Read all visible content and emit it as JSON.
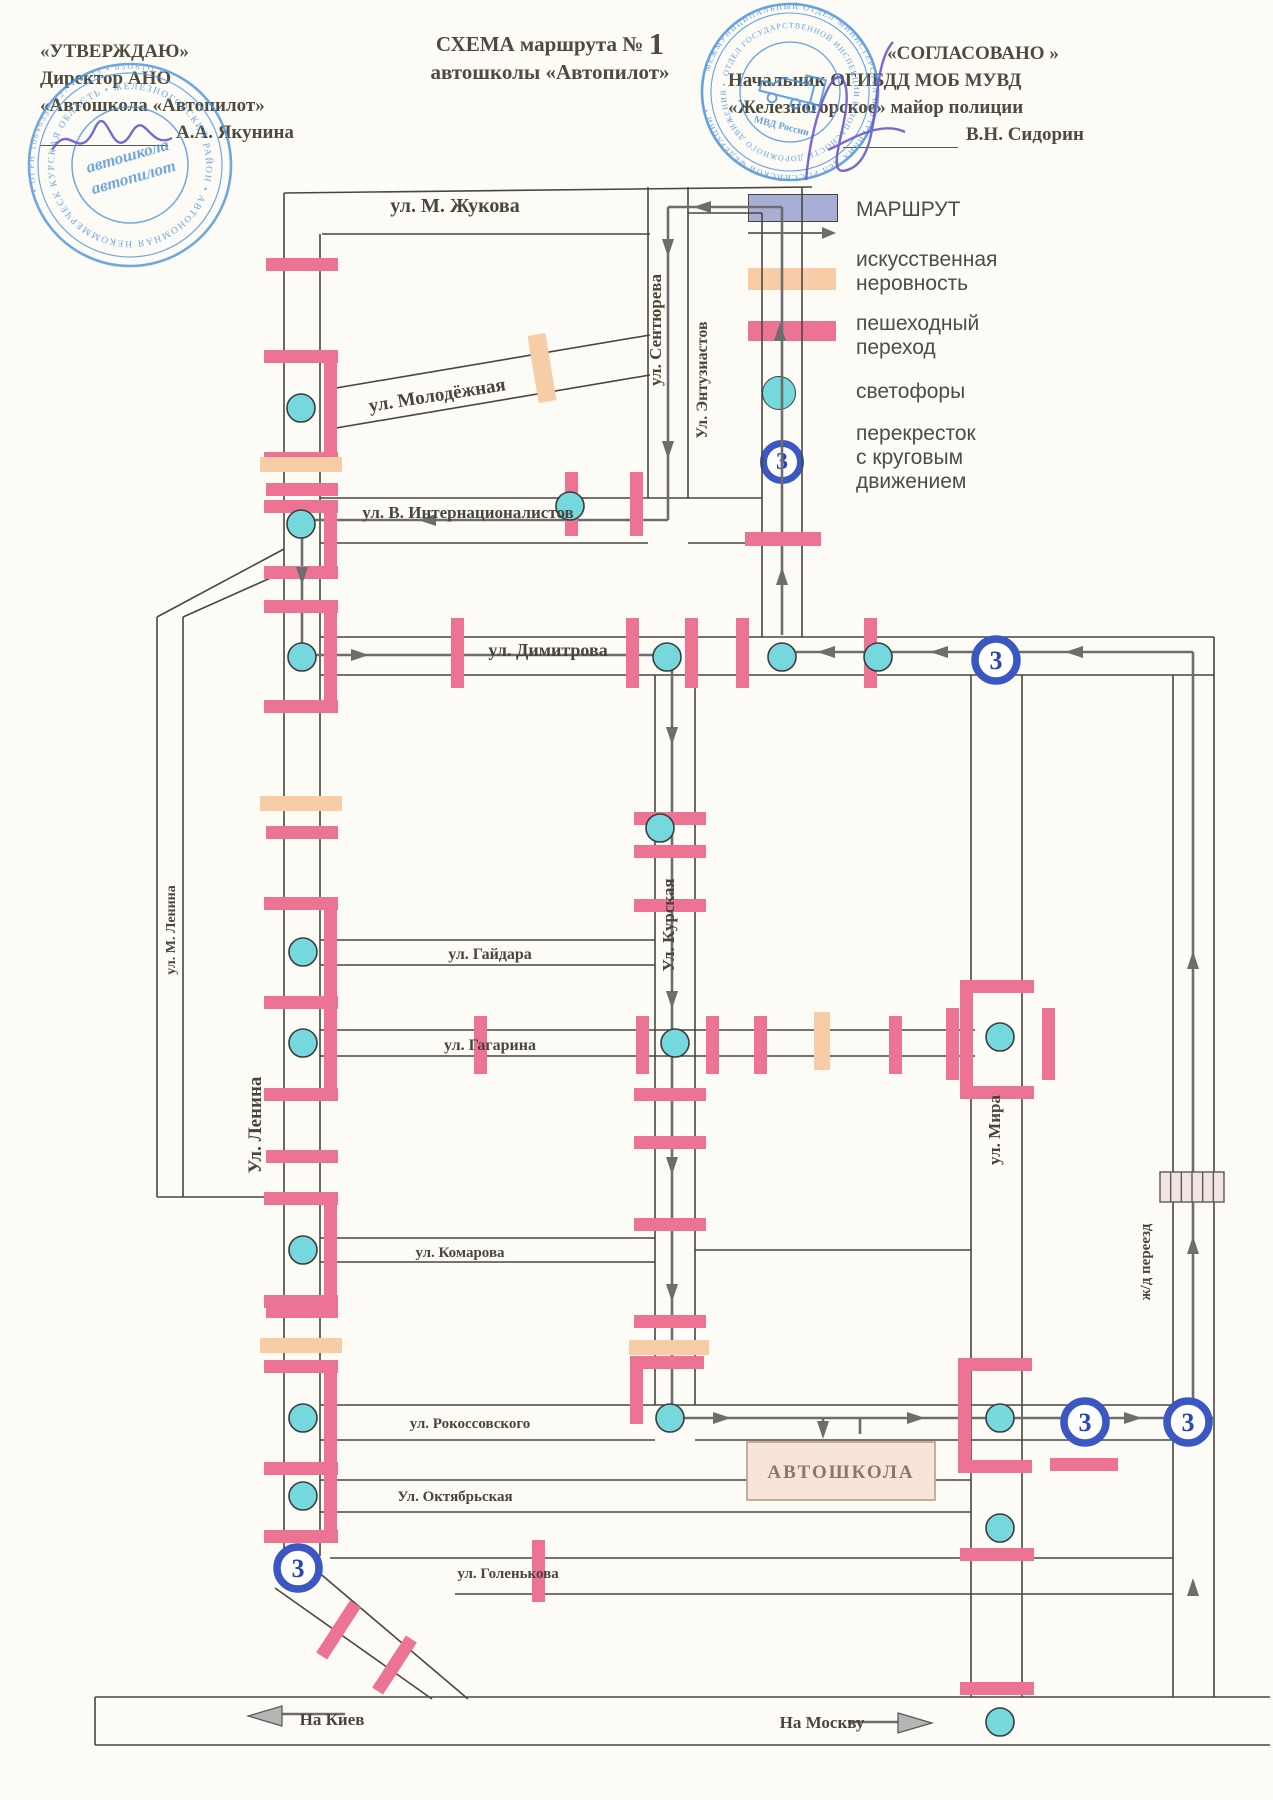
{
  "header": {
    "approve": {
      "line1": "«УТВЕРЖДАЮ»",
      "line2": "Директор АНО",
      "line3": "«Автошкола «Автопилот»",
      "name": "А.А. Якунина"
    },
    "title": {
      "prefix": "СХЕМА маршрута №",
      "number": "1",
      "line2": "автошколы «Автопилот»"
    },
    "agree": {
      "line1": "«СОГЛАСОВАНО »",
      "line2": "Начальник ОГИБДД МОБ МУВД",
      "line3": "«Железногорское» майор полиции",
      "name": "В.Н. Сидорин"
    }
  },
  "stamps": {
    "left": {
      "ring_text": "КУРСКАЯ ОБЛАСТЬ • ЖЕЛЕЗНОГОРСКИЙ РАЙОН • АВТОНОМНАЯ НЕКОММЕРЧЕСКАЯ ОРГАНИЗАЦИЯ •",
      "outer_text": "• ОГРН 106463301127 • 4633 • б5О81О •",
      "center1": "автошкола",
      "center2": "автопилот"
    },
    "right": {
      "ring_text": "ОТДЕЛ ГОСУДАРСТВЕННОЙ ИНСПЕКЦИИ БЕЗОПАСНОСТИ ДОРОЖНОГО ДВИЖЕНИЯ •",
      "outer_text": "МЕЖМУНИЦИПАЛЬНЫЙ ОТДЕЛ МИНИСТЕРСТВА ВНУТРЕННИХ ДЕЛ РОССИЙСКОЙ ФЕДЕРАЦИИ •",
      "bottom": "МВД России"
    }
  },
  "legend": {
    "route_label": "МАРШРУТ",
    "bump_label1": "искусственная",
    "bump_label2": "неровность",
    "cross_label1": "пешеходный",
    "cross_label2": "переход",
    "light_label": "светофоры",
    "round_label1": "перекресток",
    "round_label2": "с круговым",
    "round_label3": "движением"
  },
  "colors": {
    "road": "#474640",
    "route": "#6d6d6d",
    "pink": "#ec7492",
    "peach": "#f6cda6",
    "light": "#74d8dd",
    "ring": "#3a57c2",
    "number": "#2a47b2",
    "text": "#49453a",
    "lavender": "#a9aed6",
    "stamp": "#4e93d9",
    "signature": "#6a5ac8",
    "school_bg": "#f8e4d9",
    "school_border": "#bda globa"
  },
  "map": {
    "roundabout_label": "3",
    "school_label": "АВТОШКОЛА",
    "street_labels": [
      {
        "t": "ул. М. Жукова",
        "x": 455,
        "y": 212,
        "r": 0,
        "s": 20
      },
      {
        "t": "ул. Молодёжная",
        "x": 438,
        "y": 401,
        "r": -9,
        "s": 19
      },
      {
        "t": "ул. Сентюрева",
        "x": 661,
        "y": 330,
        "r": -90,
        "s": 17
      },
      {
        "t": "Ул. Энтузиастов",
        "x": 707,
        "y": 380,
        "r": -90,
        "s": 16
      },
      {
        "t": "ул. В. Интернационалистов",
        "x": 468,
        "y": 518,
        "r": 0,
        "s": 17
      },
      {
        "t": "ул. Димитрова",
        "x": 548,
        "y": 656,
        "r": 0,
        "s": 18
      },
      {
        "t": "ул. М. Ленина",
        "x": 175,
        "y": 930,
        "r": -90,
        "s": 14
      },
      {
        "t": "Ул. Ленина",
        "x": 261,
        "y": 1125,
        "r": -90,
        "s": 19
      },
      {
        "t": "ул. Гайдара",
        "x": 490,
        "y": 959,
        "r": 0,
        "s": 16
      },
      {
        "t": "Ул. Курская",
        "x": 674,
        "y": 925,
        "r": -90,
        "s": 17
      },
      {
        "t": "ул. Гагарина",
        "x": 490,
        "y": 1050,
        "r": 0,
        "s": 16
      },
      {
        "t": "ул. Мира",
        "x": 1000,
        "y": 1130,
        "r": -90,
        "s": 17
      },
      {
        "t": "ул. Комарова",
        "x": 460,
        "y": 1257,
        "r": 0,
        "s": 15
      },
      {
        "t": "ул. Рокоссовского",
        "x": 470,
        "y": 1428,
        "r": 0,
        "s": 15
      },
      {
        "t": "Ул. Октябрьская",
        "x": 455,
        "y": 1501,
        "r": 0,
        "s": 15
      },
      {
        "t": "ул. Голенькова",
        "x": 508,
        "y": 1578,
        "r": 0,
        "s": 15
      },
      {
        "t": "ж/д переезд",
        "x": 1150,
        "y": 1262,
        "r": -90,
        "s": 15
      },
      {
        "t": "На Киев",
        "x": 332,
        "y": 1725,
        "r": 0,
        "s": 17
      },
      {
        "t": "На Москву",
        "x": 822,
        "y": 1728,
        "r": 0,
        "s": 17
      }
    ],
    "road_lines": [
      [
        284,
        193,
        812,
        187
      ],
      [
        322,
        234,
        650,
        234
      ],
      [
        688,
        213,
        762,
        213
      ],
      [
        284,
        193,
        284,
        1552
      ],
      [
        320,
        234,
        320,
        1556
      ],
      [
        648,
        187,
        648,
        498
      ],
      [
        688,
        187,
        688,
        498
      ],
      [
        762,
        213,
        762,
        637
      ],
      [
        802,
        187,
        802,
        637
      ],
      [
        330,
        389,
        650,
        335
      ],
      [
        330,
        429,
        650,
        375
      ],
      [
        320,
        498,
        762,
        498
      ],
      [
        320,
        543,
        648,
        543
      ],
      [
        688,
        543,
        762,
        543
      ],
      [
        320,
        637,
        1214,
        637
      ],
      [
        320,
        675,
        1214,
        675
      ],
      [
        157,
        617,
        157,
        1197
      ],
      [
        183,
        617,
        183,
        1197
      ],
      [
        157,
        617,
        284,
        549
      ],
      [
        183,
        617,
        284,
        572
      ],
      [
        157,
        1197,
        283,
        1197
      ],
      [
        320,
        940,
        655,
        940
      ],
      [
        320,
        965,
        655,
        965
      ],
      [
        655,
        675,
        655,
        1405
      ],
      [
        695,
        675,
        695,
        1405
      ],
      [
        320,
        1030,
        975,
        1030
      ],
      [
        320,
        1056,
        975,
        1056
      ],
      [
        971,
        675,
        971,
        1697
      ],
      [
        1022,
        675,
        1022,
        1697
      ],
      [
        320,
        1238,
        655,
        1238
      ],
      [
        320,
        1262,
        655,
        1262
      ],
      [
        695,
        1250,
        971,
        1250
      ],
      [
        320,
        1405,
        1173,
        1405
      ],
      [
        320,
        1440,
        655,
        1440
      ],
      [
        695,
        1440,
        1173,
        1440
      ],
      [
        320,
        1480,
        971,
        1480
      ],
      [
        320,
        1512,
        971,
        1512
      ],
      [
        330,
        1558,
        1173,
        1558
      ],
      [
        455,
        1594,
        1173,
        1594
      ],
      [
        95,
        1697,
        1270,
        1697
      ],
      [
        95,
        1745,
        1270,
        1745
      ],
      [
        95,
        1697,
        95,
        1745
      ],
      [
        275,
        1588,
        432,
        1699
      ],
      [
        310,
        1565,
        468,
        1699
      ],
      [
        1173,
        675,
        1173,
        1697
      ],
      [
        1214,
        637,
        1214,
        1697
      ]
    ],
    "route_lines": [
      [
        782,
        635,
        782,
        207
      ],
      [
        782,
        207,
        668,
        207
      ],
      [
        668,
        207,
        668,
        520
      ],
      [
        668,
        520,
        302,
        520
      ],
      [
        302,
        520,
        302,
        652
      ],
      [
        302,
        655,
        672,
        655
      ],
      [
        672,
        655,
        672,
        1418
      ],
      [
        672,
        1418,
        1214,
        1418
      ],
      [
        823,
        1418,
        823,
        1434
      ],
      [
        860,
        1434,
        860,
        1418
      ],
      [
        1193,
        1418,
        1193,
        652
      ],
      [
        1193,
        652,
        782,
        652
      ],
      [
        260,
        1714,
        345,
        1714
      ],
      [
        848,
        1722,
        915,
        1722
      ]
    ],
    "arrows": [
      [
        700,
        207,
        180
      ],
      [
        668,
        250,
        90
      ],
      [
        668,
        452,
        90
      ],
      [
        780,
        330,
        270
      ],
      [
        782,
        574,
        270
      ],
      [
        425,
        520,
        180
      ],
      [
        302,
        578,
        90
      ],
      [
        362,
        655,
        0
      ],
      [
        672,
        738,
        90
      ],
      [
        672,
        1002,
        90
      ],
      [
        672,
        1168,
        90
      ],
      [
        672,
        1295,
        90
      ],
      [
        724,
        1418,
        0
      ],
      [
        823,
        1432,
        90
      ],
      [
        918,
        1418,
        0
      ],
      [
        1135,
        1418,
        0
      ],
      [
        1193,
        1243,
        270
      ],
      [
        1193,
        958,
        270
      ],
      [
        1193,
        1585,
        270
      ],
      [
        824,
        652,
        180
      ],
      [
        937,
        652,
        180
      ],
      [
        1072,
        652,
        180
      ]
    ],
    "big_arrows": [
      [
        258,
        1716,
        180
      ],
      [
        922,
        1723,
        0
      ]
    ],
    "lights": [
      [
        301,
        408
      ],
      [
        301,
        524
      ],
      [
        302,
        657
      ],
      [
        570,
        506
      ],
      [
        667,
        657
      ],
      [
        782,
        657
      ],
      [
        878,
        657
      ],
      [
        660,
        828
      ],
      [
        303,
        952
      ],
      [
        303,
        1043
      ],
      [
        675,
        1043
      ],
      [
        1000,
        1037
      ],
      [
        303,
        1250
      ],
      [
        303,
        1418
      ],
      [
        670,
        1418
      ],
      [
        1000,
        1418
      ],
      [
        303,
        1496
      ],
      [
        1000,
        1528
      ],
      [
        1000,
        1722
      ]
    ],
    "roundabouts": [
      [
        996,
        660
      ],
      [
        298,
        1568
      ],
      [
        1085,
        1422
      ],
      [
        1188,
        1422
      ]
    ],
    "crossings": [
      [
        266,
        258,
        72,
        13
      ],
      [
        266,
        483,
        72,
        13
      ],
      [
        266,
        826,
        72,
        13
      ],
      [
        266,
        1150,
        72,
        13
      ],
      [
        266,
        1305,
        72,
        13
      ],
      [
        264,
        350,
        74,
        13
      ],
      [
        264,
        452,
        74,
        13
      ],
      [
        324,
        350,
        13,
        115
      ],
      [
        264,
        500,
        74,
        13
      ],
      [
        264,
        566,
        74,
        13
      ],
      [
        324,
        500,
        13,
        79
      ],
      [
        264,
        600,
        74,
        13
      ],
      [
        264,
        700,
        74,
        13
      ],
      [
        324,
        600,
        13,
        113
      ],
      [
        264,
        897,
        74,
        13
      ],
      [
        264,
        996,
        74,
        13
      ],
      [
        324,
        897,
        13,
        112
      ],
      [
        264,
        1088,
        74,
        13
      ],
      [
        324,
        996,
        13,
        105
      ],
      [
        264,
        1192,
        74,
        13
      ],
      [
        264,
        1295,
        74,
        13
      ],
      [
        324,
        1192,
        13,
        116
      ],
      [
        264,
        1360,
        74,
        13
      ],
      [
        264,
        1462,
        74,
        13
      ],
      [
        324,
        1360,
        13,
        115
      ],
      [
        264,
        1530,
        74,
        13
      ],
      [
        324,
        1462,
        13,
        81
      ],
      [
        565,
        472,
        13,
        64
      ],
      [
        630,
        472,
        13,
        64
      ],
      [
        745,
        532,
        76,
        14
      ],
      [
        451,
        618,
        13,
        70
      ],
      [
        626,
        618,
        13,
        70
      ],
      [
        685,
        618,
        13,
        70
      ],
      [
        736,
        618,
        13,
        70
      ],
      [
        864,
        618,
        13,
        70
      ],
      [
        634,
        812,
        72,
        13
      ],
      [
        634,
        845,
        72,
        13
      ],
      [
        634,
        899,
        72,
        13
      ],
      [
        634,
        1088,
        72,
        13
      ],
      [
        634,
        1136,
        72,
        13
      ],
      [
        634,
        1218,
        72,
        13
      ],
      [
        634,
        1315,
        72,
        13
      ],
      [
        630,
        1356,
        74,
        13
      ],
      [
        630,
        1369,
        13,
        55
      ],
      [
        474,
        1016,
        13,
        58
      ],
      [
        636,
        1016,
        13,
        58
      ],
      [
        706,
        1016,
        13,
        58
      ],
      [
        754,
        1016,
        13,
        58
      ],
      [
        889,
        1016,
        13,
        58
      ],
      [
        946,
        1008,
        13,
        72
      ],
      [
        1042,
        1008,
        13,
        72
      ],
      [
        960,
        980,
        74,
        13
      ],
      [
        960,
        1086,
        74,
        13
      ],
      [
        960,
        980,
        13,
        119
      ],
      [
        958,
        1358,
        74,
        13
      ],
      [
        958,
        1460,
        74,
        13
      ],
      [
        958,
        1358,
        13,
        115
      ],
      [
        960,
        1548,
        74,
        13
      ],
      [
        960,
        1682,
        74,
        13
      ],
      [
        1050,
        1458,
        68,
        13
      ],
      [
        532,
        1540,
        13,
        62
      ],
      [
        332,
        1599,
        13,
        62,
        33
      ],
      [
        388,
        1634,
        13,
        62,
        33
      ]
    ],
    "bumps": [
      [
        260,
        457,
        82,
        15
      ],
      [
        260,
        796,
        82,
        15
      ],
      [
        260,
        1338,
        82,
        15
      ],
      [
        629,
        1340,
        80,
        15
      ],
      [
        814,
        1012,
        16,
        58
      ],
      [
        533,
        334,
        18,
        68,
        -9.5
      ]
    ],
    "railroad": {
      "x": 1160,
      "y": 1172,
      "w": 64,
      "h": 30
    },
    "school_box": {
      "x": 747,
      "y": 1442,
      "w": 188,
      "h": 58
    }
  }
}
